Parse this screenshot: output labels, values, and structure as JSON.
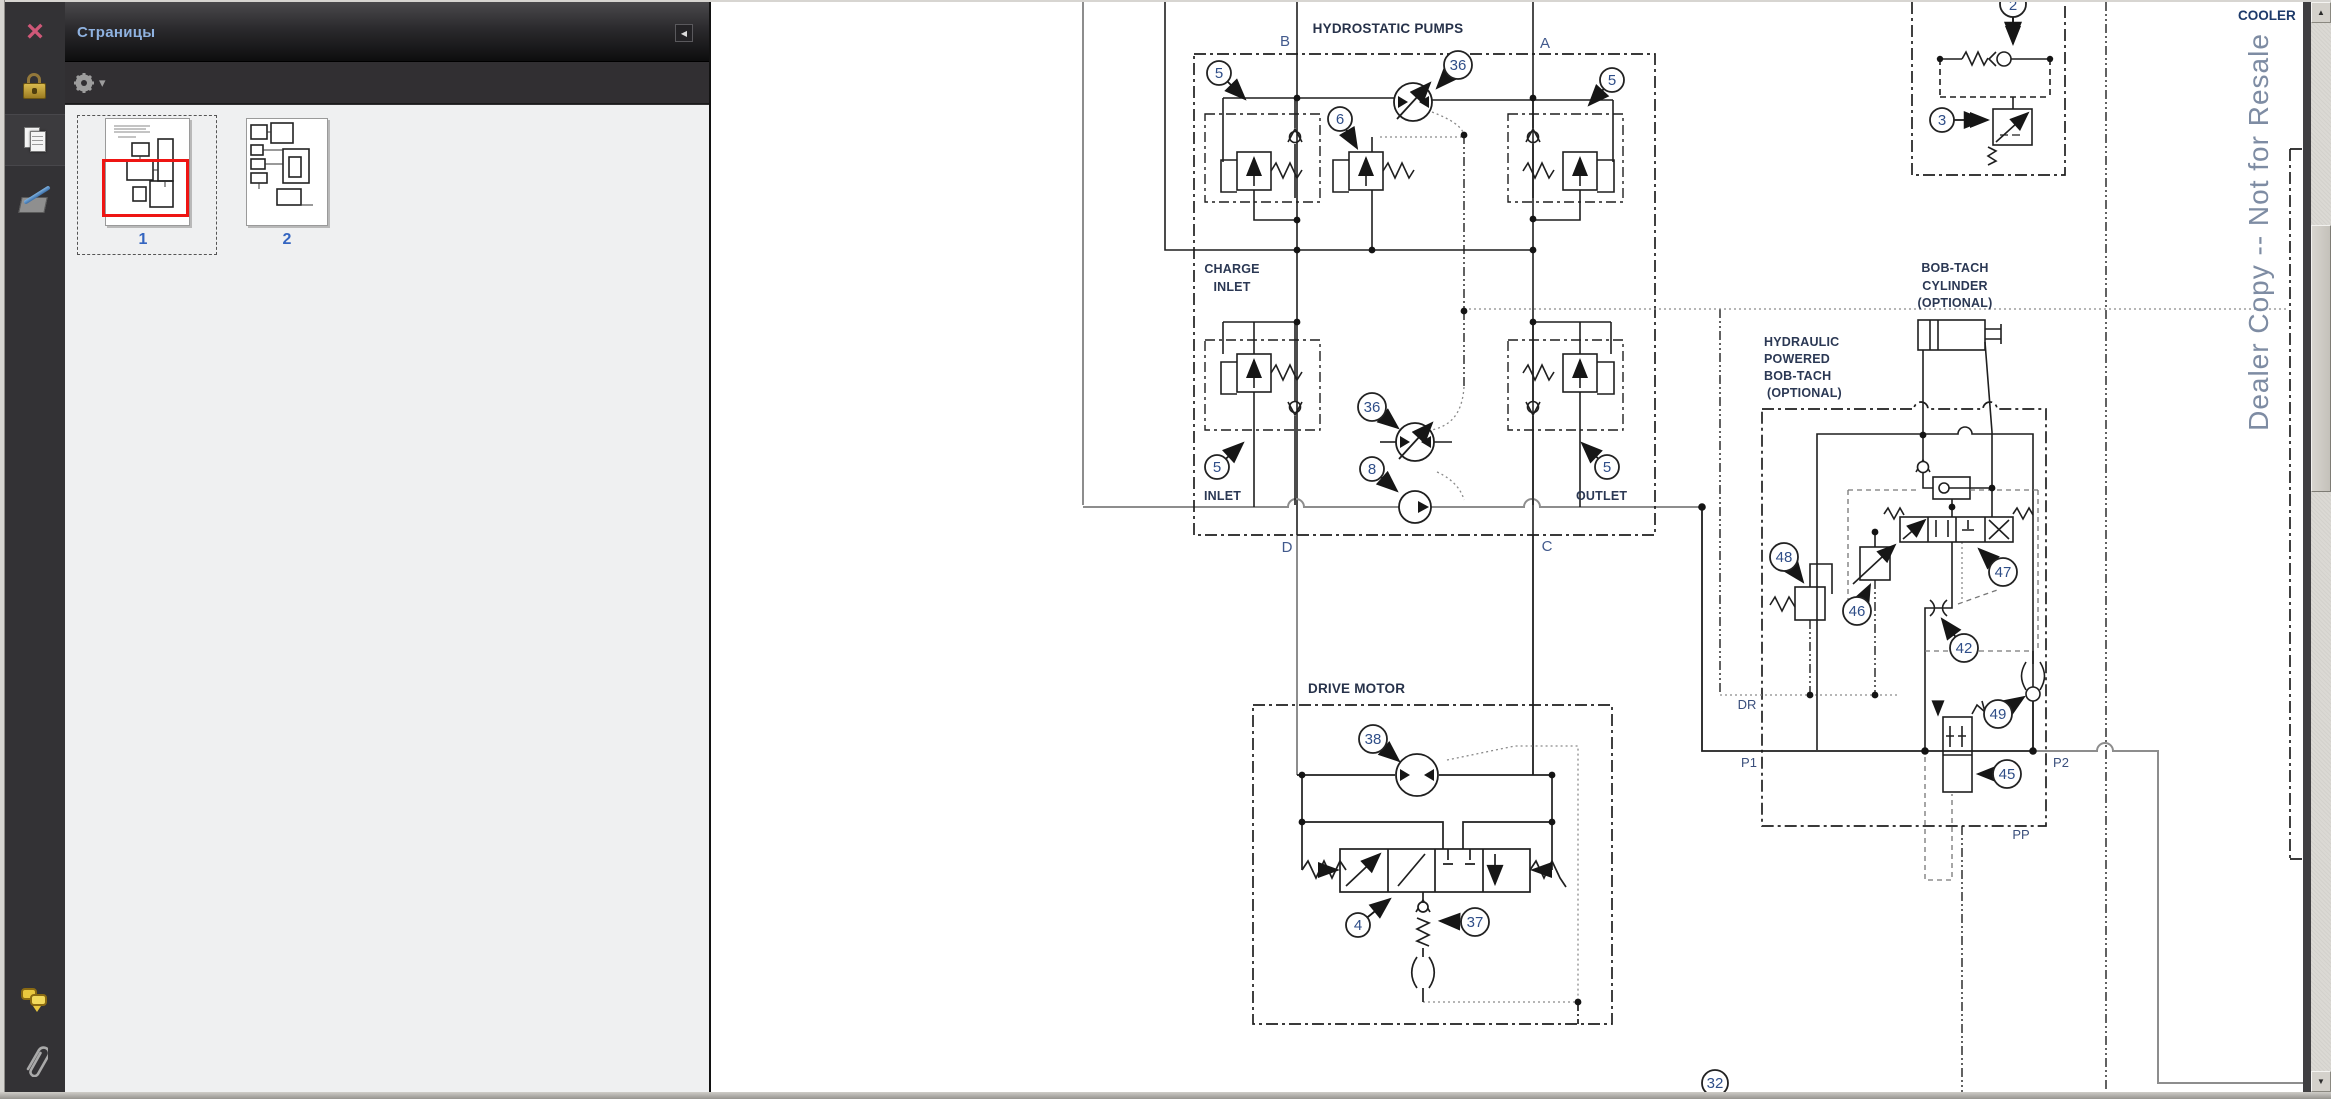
{
  "panel": {
    "title": "Страницы",
    "page_numbers": [
      "1",
      "2"
    ]
  },
  "glyphs": {
    "close": "×",
    "collapse": "◀",
    "menu_caret": "▾",
    "scroll_up": "▲",
    "scroll_down": "▼"
  },
  "diagram": {
    "labels": {
      "hydrostatic_pumps": "HYDROSTATIC PUMPS",
      "charge_line1": "CHARGE",
      "charge_line2": "INLET",
      "inlet": "INLET",
      "outlet": "OUTLET",
      "drive_motor": "DRIVE MOTOR",
      "bobtach_cylinder_1": "BOB-TACH",
      "bobtach_cylinder_2": "CYLINDER",
      "bobtach_cylinder_3": "(OPTIONAL)",
      "hyd_bobtach_1": "HYDRAULIC",
      "hyd_bobtach_2": "POWERED",
      "hyd_bobtach_3": "BOB-TACH",
      "hyd_bobtach_4": "(OPTIONAL)",
      "cooler": "COOLER"
    },
    "ports": {
      "b": "B",
      "a": "A",
      "d": "D",
      "c": "C",
      "dr": "DR",
      "p1": "P1",
      "p2": "P2",
      "pp": "PP"
    },
    "balloons": {
      "n2": "2",
      "n3": "3",
      "n4": "4",
      "n5": "5",
      "n6": "6",
      "n8": "8",
      "n32": "32",
      "n36": "36",
      "n37": "37",
      "n38": "38",
      "n42": "42",
      "n45": "45",
      "n46": "46",
      "n47": "47",
      "n48": "48",
      "n49": "49"
    },
    "watermark": "Dealer Copy -- Not for Resale"
  },
  "colors": {
    "accent_title": "#8fb2e0",
    "view_rect_red": "#ee1513",
    "balloon_number": "#2f4e88",
    "watermark_gray": "#7e8ca3"
  }
}
